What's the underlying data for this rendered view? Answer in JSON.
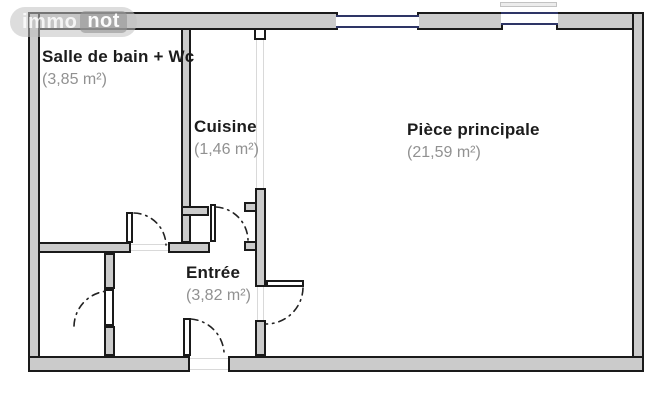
{
  "watermark": {
    "brand_left": "immo",
    "brand_right": "not"
  },
  "floorplan": {
    "rooms": [
      {
        "id": "bathroom",
        "name": "Salle de bain + Wc",
        "area": "(3,85 m²)"
      },
      {
        "id": "kitchen",
        "name": "Cuisine",
        "area": "(1,46 m²)"
      },
      {
        "id": "main",
        "name": "Pièce principale",
        "area": "(21,59 m²)"
      },
      {
        "id": "entry",
        "name": "Entrée",
        "area": "(3,82 m²)"
      }
    ],
    "colors": {
      "wall_fill": "#cbcbcb",
      "wall_outline": "#1a1a1a",
      "window_frame": "#2e3566",
      "room_name_text": "#1c1c1c",
      "room_area_text": "#919191",
      "door_arc": "#222222",
      "watermark_pill": "#c1c1c1"
    }
  }
}
